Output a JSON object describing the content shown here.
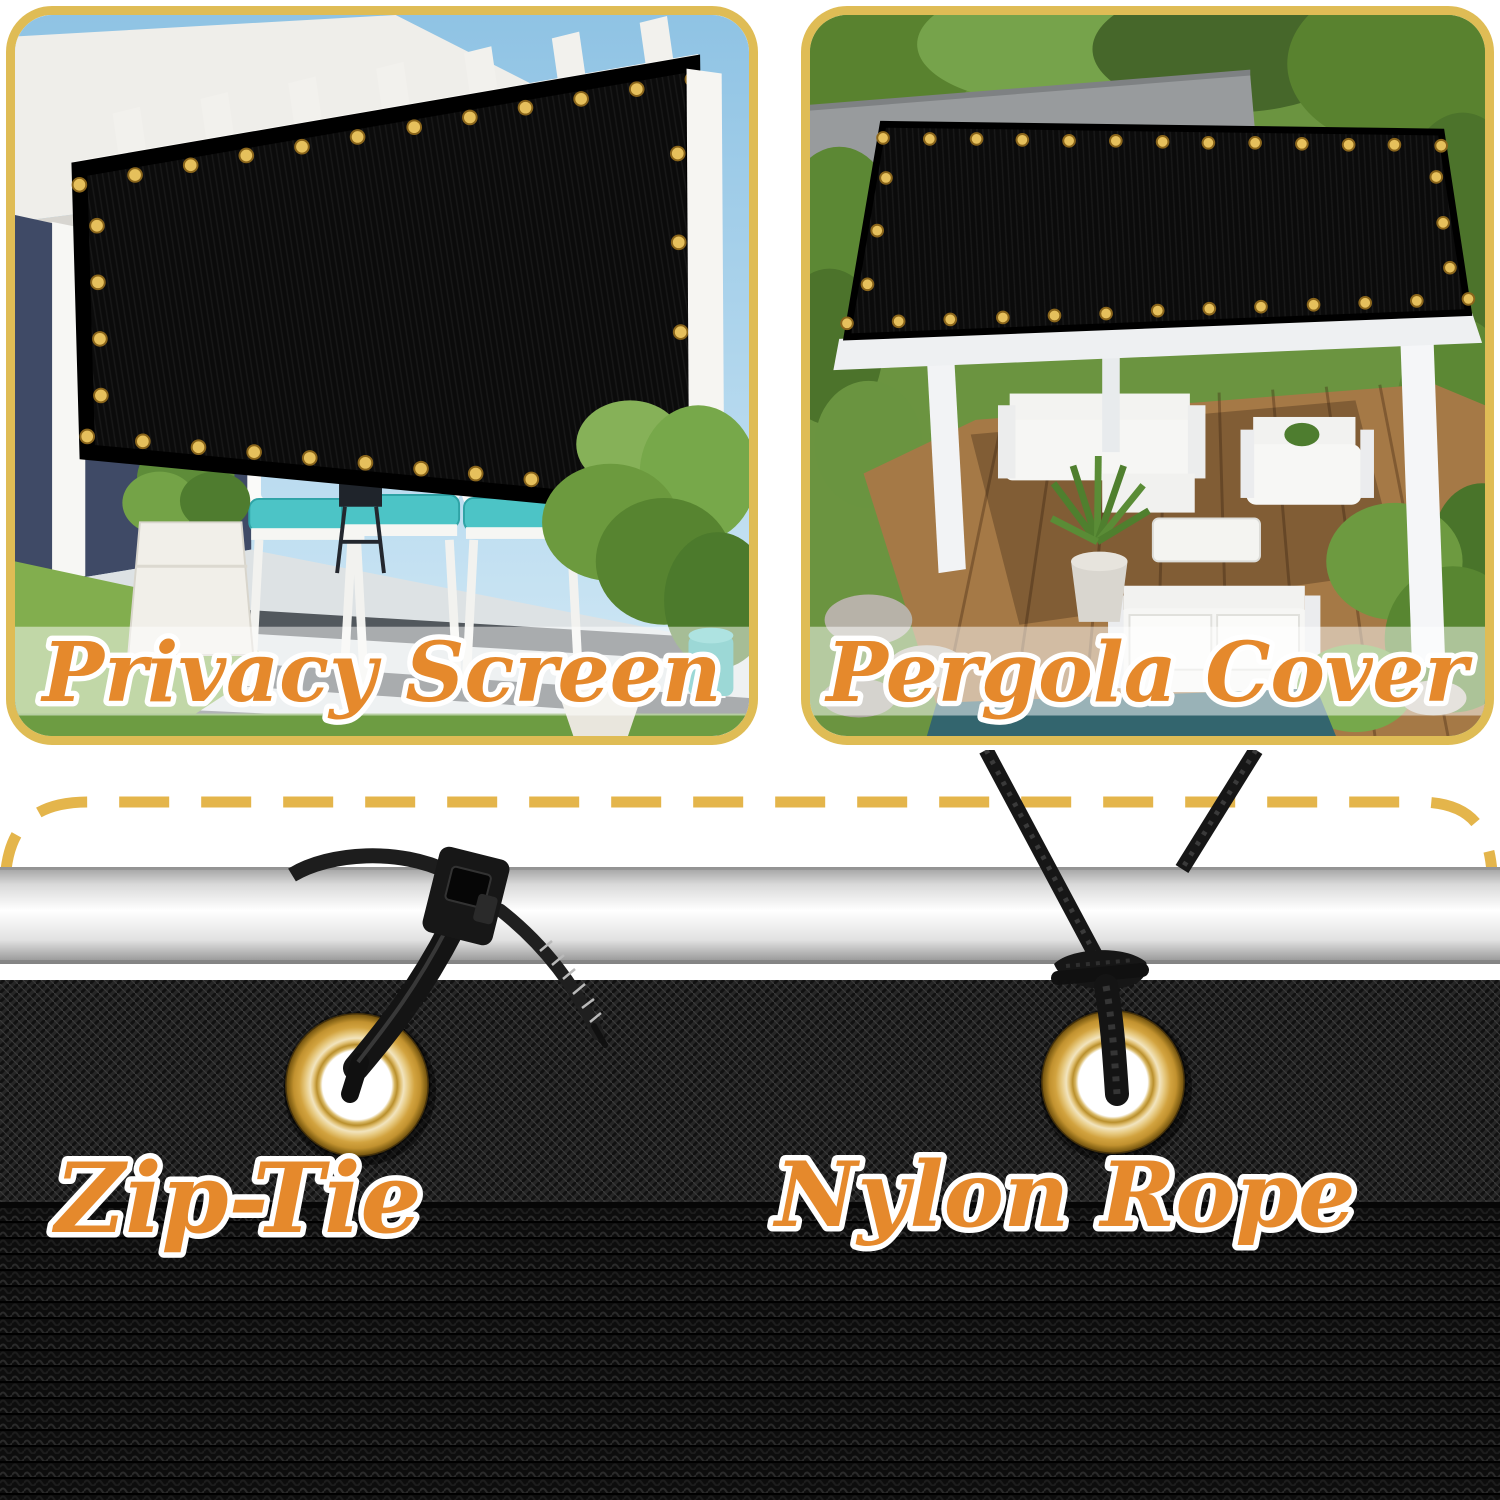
{
  "product_showcase": {
    "panels": [
      {
        "id": "privacy-screen",
        "label": "Privacy Screen"
      },
      {
        "id": "pergola-cover",
        "label": "Pergola Cover"
      }
    ],
    "hardware_labels": {
      "zip_tie": "Zip-Tie",
      "nylon_rope": "Nylon Rope"
    }
  },
  "colors": {
    "accent_orange": "#e5892c",
    "gold_border": "#dfbc55",
    "dash_gold": "#e4b54b",
    "grommet_brass": "#d9a843",
    "mesh_black": "#121212",
    "teal_cushion": "#4cc4c6"
  }
}
